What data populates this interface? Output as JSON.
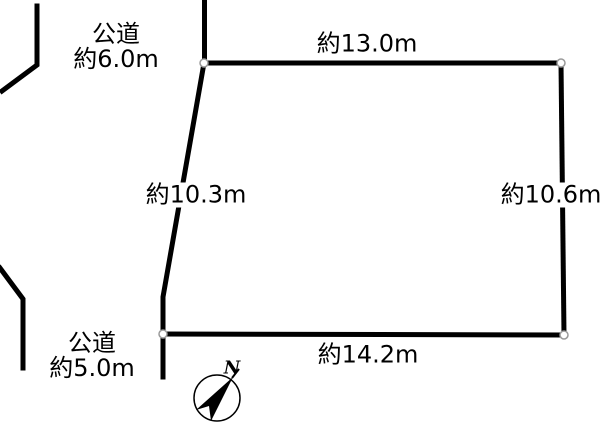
{
  "diagram_type": "land-plot-survey-sketch",
  "colors": {
    "line_color": "#000000",
    "bg_color": "#ffffff",
    "dot_fill": "#ffffff",
    "dot_stroke": "#999999"
  },
  "roads": [
    {
      "position": "top-left",
      "name": "公道",
      "width_label": "約6.0m",
      "width_m": 6.0
    },
    {
      "position": "bottom-left",
      "name": "公道",
      "width_label": "約5.0m",
      "width_m": 5.0
    }
  ],
  "edges": [
    {
      "side": "top",
      "length_label": "約13.0m",
      "length_m": 13.0
    },
    {
      "side": "right",
      "length_label": "約10.6m",
      "length_m": 10.6
    },
    {
      "side": "bottom",
      "length_label": "約14.2m",
      "length_m": 14.2
    },
    {
      "side": "left",
      "length_label": "約10.3m",
      "length_m": 10.3
    }
  ],
  "compass": {
    "north_label": "N"
  }
}
